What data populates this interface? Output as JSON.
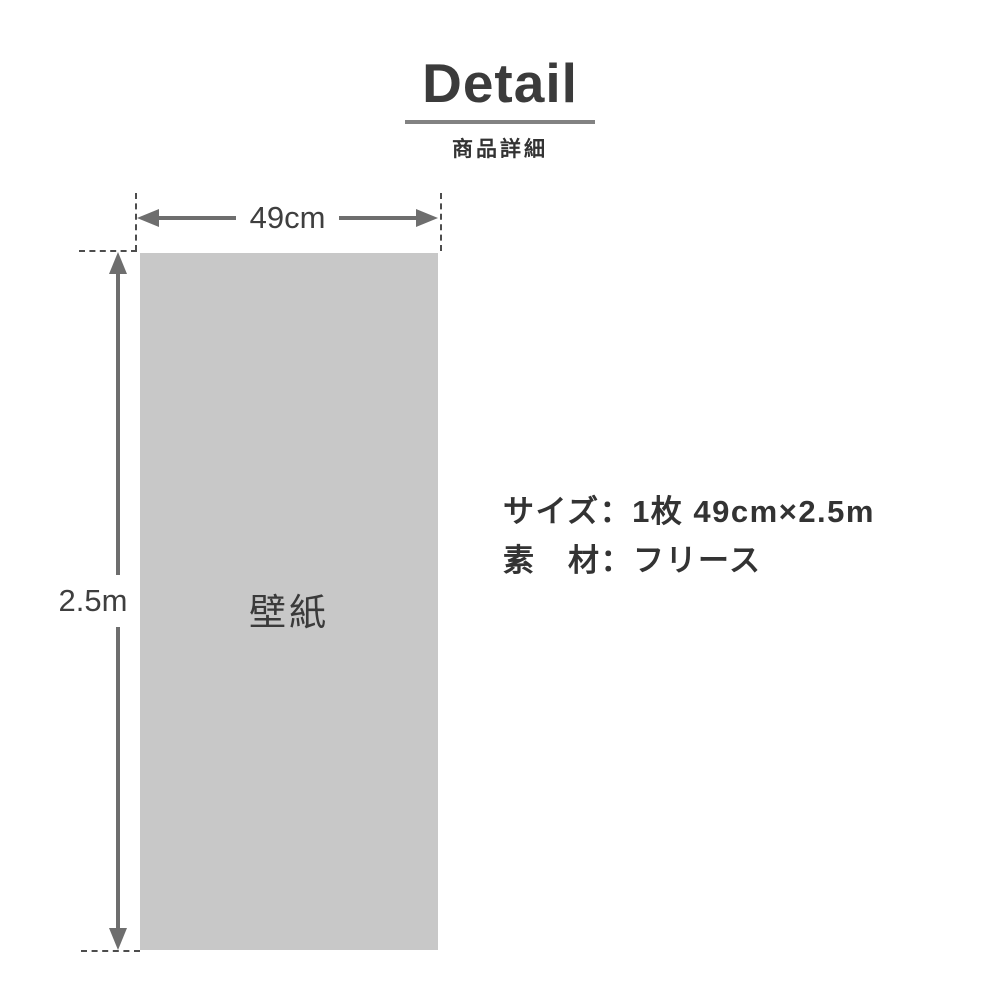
{
  "header": {
    "title": "Detail",
    "subtitle": "商品詳細"
  },
  "diagram": {
    "panel_label": "壁紙",
    "width_label": "49cm",
    "height_label": "2.5m"
  },
  "specs": {
    "size": "サイズ：1枚 49cm×2.5m",
    "material": "素　材：フリース"
  },
  "colors": {
    "background": "#ffffff",
    "panel_fill": "#c8c8c8",
    "dimension_arrow": "#6e6e6e",
    "dashed_guide": "#4d4d4d",
    "heading_text": "#3b3b3b",
    "body_text": "#333333",
    "title_underline": "#828282"
  }
}
